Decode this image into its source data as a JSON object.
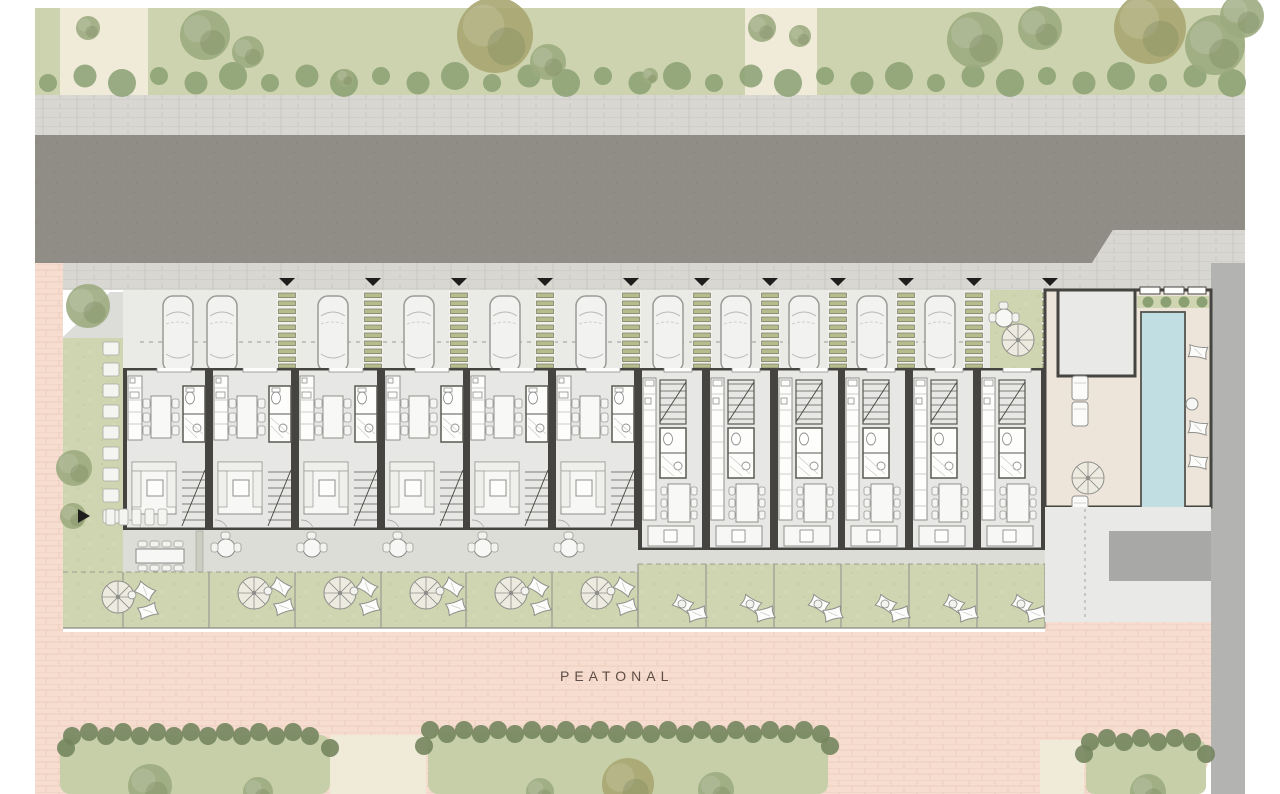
{
  "plan": {
    "labels": {
      "pedestrian_zone": "PEATONAL"
    },
    "colors": {
      "bg": "#ffffff",
      "green_band": "#ccd3ae",
      "grass": "#cfd5b0",
      "grass_dark": "#c6cfa8",
      "road": "#908c86",
      "sidewalk": "#d8d7d2",
      "paver_line": "#c8c7c1",
      "pink": "#f6ddd0",
      "brick_line": "#eccdbd",
      "parking_floor": "#eaebe7",
      "unit_floor": "#e7e7e5",
      "wall": "#454441",
      "furniture": "#fbfbf9",
      "furniture_stroke": "#8f8f8c",
      "terrace": "#dcddd7",
      "ladder_green": "#b6bc8c",
      "pool": "#c1dee2",
      "amenity_floor": "#ede5d9",
      "gray_band": "#b3b3b1",
      "ramp": "#a8a8a6",
      "hedge": "#74855e",
      "tree_green": "#9cab7f",
      "tree_olive": "#a9a671",
      "shrub": "#8aa073",
      "plaza": "#e9e9e7",
      "beige_path": "#f0ead9",
      "marker": "#1e1e1c"
    },
    "units": {
      "type_a_xs": [
        123,
        209,
        295,
        381,
        466,
        552
      ],
      "a_width": 86,
      "type_b_xs": [
        638,
        706,
        774,
        841,
        909,
        977
      ],
      "b_width": 68
    },
    "parking": {
      "ladder_xs": [
        287,
        373,
        459,
        545,
        631,
        702,
        770,
        838,
        906,
        974,
        1050
      ],
      "marker_xs": [
        287,
        373,
        459,
        545,
        631,
        702,
        770,
        838,
        906,
        974,
        1050
      ],
      "car_xs": [
        178,
        222,
        333,
        419,
        505,
        591,
        668,
        736,
        804,
        872,
        940
      ],
      "garage_car": {
        "x": 1096,
        "y": 296
      },
      "courtyard": {
        "x": 990,
        "w": 52,
        "table_x": 1004,
        "table_y": 318,
        "parasol_x": 1018,
        "parasol_y": 340
      }
    },
    "terrace": {
      "a_round_tables": [
        [
          226,
          548
        ],
        [
          312,
          548
        ],
        [
          398,
          548
        ],
        [
          483,
          548
        ],
        [
          569,
          548
        ]
      ],
      "a_rect_table": [
        160,
        556
      ],
      "b_garden_tables": [
        [
          663,
          588
        ],
        [
          731,
          588
        ],
        [
          799,
          588
        ],
        [
          866,
          588
        ],
        [
          934,
          588
        ],
        [
          1002,
          588
        ]
      ]
    },
    "gardens": {
      "a_parasols": [
        [
          118,
          597
        ],
        [
          254,
          593
        ],
        [
          340,
          593
        ],
        [
          426,
          593
        ],
        [
          511,
          593
        ],
        [
          597,
          593
        ]
      ],
      "b_pillow_xs": [
        678,
        746,
        814,
        881,
        949,
        1017
      ]
    },
    "vegetation": {
      "top_trees": [
        [
          205,
          35,
          25,
          "g"
        ],
        [
          248,
          52,
          16,
          "g"
        ],
        [
          495,
          35,
          38,
          "o"
        ],
        [
          548,
          62,
          18,
          "g"
        ],
        [
          762,
          28,
          14,
          "g"
        ],
        [
          800,
          36,
          11,
          "g"
        ],
        [
          975,
          40,
          28,
          "g"
        ],
        [
          1040,
          28,
          22,
          "g"
        ],
        [
          1150,
          28,
          36,
          "o"
        ],
        [
          1215,
          45,
          30,
          "g"
        ],
        [
          1242,
          16,
          22,
          "g"
        ],
        [
          88,
          28,
          12,
          "g"
        ],
        [
          345,
          78,
          9,
          "g"
        ],
        [
          650,
          76,
          8,
          "g"
        ]
      ],
      "left_garden_trees": [
        [
          88,
          306,
          22,
          "g"
        ],
        [
          74,
          468,
          18,
          "g"
        ],
        [
          73,
          516,
          13,
          "g"
        ]
      ],
      "bottom_trees": [
        [
          150,
          786,
          22,
          "g"
        ],
        [
          258,
          792,
          15,
          "g"
        ],
        [
          540,
          792,
          14,
          "g"
        ],
        [
          628,
          784,
          26,
          "o"
        ],
        [
          716,
          790,
          18,
          "g"
        ],
        [
          1148,
          792,
          18,
          "g"
        ]
      ],
      "shrub_row": {
        "x0": 48,
        "x1": 1238,
        "y": 80,
        "step": 37
      },
      "hedges": [
        {
          "x0": 72,
          "x1": 324,
          "y": 734,
          "step": 17
        },
        {
          "x0": 430,
          "x1": 824,
          "y": 732,
          "step": 17
        },
        {
          "x0": 1090,
          "x1": 1200,
          "y": 740,
          "step": 17
        }
      ]
    },
    "stepping_stones": {
      "column": {
        "x": 103,
        "y0": 342,
        "step": 21,
        "count": 9
      },
      "row": {
        "x0": 106,
        "y": 509,
        "step": 13,
        "count": 5
      }
    },
    "pool_area": {
      "loungers_right": [
        [
          1198,
          352
        ],
        [
          1198,
          428
        ],
        [
          1198,
          462
        ]
      ],
      "loungers_left": [
        [
          1080,
          388
        ],
        [
          1080,
          414
        ],
        [
          1080,
          508
        ],
        [
          1080,
          536
        ]
      ],
      "side_table": [
        1192,
        404
      ],
      "parasol": [
        1088,
        478
      ]
    }
  }
}
